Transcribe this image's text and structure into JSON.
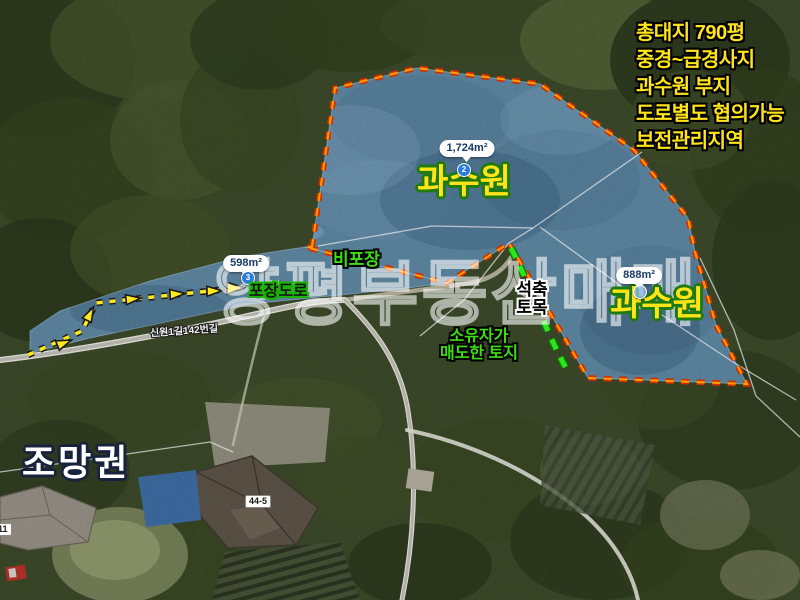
{
  "header_notes": {
    "lines": [
      "총대지 790평",
      "중경~급경사지",
      "과수원 부지",
      "도로별도 협의가능",
      "보전관리지역"
    ],
    "color": "#ffe41a"
  },
  "watermark": "양평부동산매매",
  "parcels": {
    "orchard_main": {
      "label": "과수원",
      "area": "1,724m²",
      "marker": "2"
    },
    "orchard_east": {
      "label": "과수원",
      "area": "888m²",
      "marker": ""
    },
    "road_parcel": {
      "area": "598m²",
      "marker": "3"
    }
  },
  "road_notes": {
    "unpaved": "비포장",
    "paved": "포장도로"
  },
  "site_notes": {
    "stonework_lines": [
      "석축",
      "토목"
    ],
    "owner_lines": [
      "소유자가",
      "매도한 토지"
    ]
  },
  "view_note": "조망권",
  "map_base_labels": {
    "road_name": "신원1길142번길",
    "building_no": "44-5",
    "building_no_partial": "11"
  },
  "colors": {
    "boundary_red": "#d42b00",
    "boundary_core": "#ff9a00",
    "parcel_fill_blue": "#3e84d0",
    "route_yellow": "#ffe81e",
    "note_green": "#3ddd11",
    "label_yellow": "#ffe41a",
    "stonework_green": "#2be61c"
  }
}
